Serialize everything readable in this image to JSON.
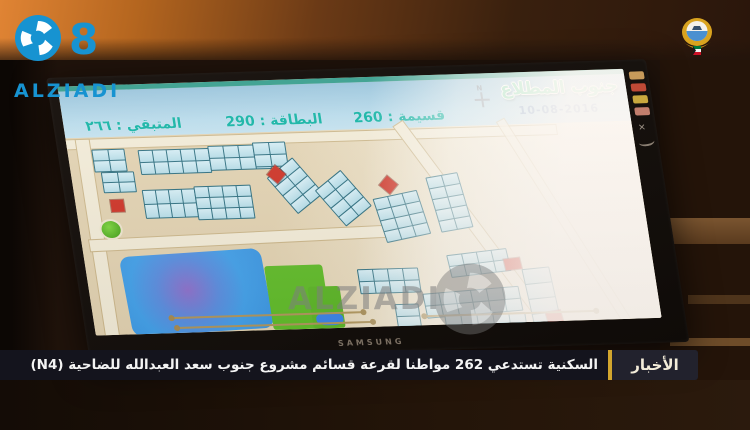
{
  "overlay": {
    "logo": {
      "eight": "8",
      "name": "ALZIADI"
    },
    "watermark": "ALZIADI",
    "ticker": {
      "label": "الأخبار",
      "text": "السكنية تستدعي 262 مواطنا لقرعة قسائم مشروع جنوب سعد العبدالله للضاحية (N4)"
    }
  },
  "monitor": {
    "brand": "SAMSUNG",
    "side_stickers": [
      {
        "color": "#c79a5a"
      },
      {
        "color": "#bf4a36"
      },
      {
        "color": "#c9a83e"
      },
      {
        "color": "#c27e6d"
      }
    ],
    "side_x": "✕",
    "screen": {
      "header": {
        "title": "جنوب المطلاع",
        "date": "10-08-2016",
        "plot": "قسيمة : 260",
        "card": "البطاقة : 290",
        "remaining": "المتبقي : ٢٦٦",
        "badge": "196",
        "compass_label": "N"
      },
      "map": {
        "blocks": [
          {
            "x": 24,
            "y": 12,
            "cols": 2,
            "rows": 2,
            "cw": 15,
            "ch": 10,
            "rot": 0
          },
          {
            "x": 30,
            "y": 35,
            "cols": 2,
            "rows": 2,
            "cw": 15,
            "ch": 9,
            "rot": 0
          },
          {
            "x": 70,
            "y": 14,
            "cols": 5,
            "rows": 2,
            "cw": 13,
            "ch": 11,
            "rot": 0
          },
          {
            "x": 140,
            "y": 12,
            "cols": 4,
            "rows": 2,
            "cw": 14,
            "ch": 11,
            "rot": 0
          },
          {
            "x": 185,
            "y": 10,
            "cols": 2,
            "rows": 2,
            "cw": 15,
            "ch": 11,
            "rot": 0
          },
          {
            "x": 68,
            "y": 54,
            "cols": 4,
            "rows": 2,
            "cw": 12,
            "ch": 13,
            "rot": 0
          },
          {
            "x": 120,
            "y": 52,
            "cols": 4,
            "rows": 3,
            "cw": 13,
            "ch": 10,
            "rot": 0
          },
          {
            "x": 204,
            "y": 32,
            "cols": 2,
            "rows": 4,
            "cw": 16,
            "ch": 10,
            "rot": -35
          },
          {
            "x": 250,
            "y": 46,
            "cols": 2,
            "rows": 4,
            "cw": 16,
            "ch": 10,
            "rot": -35
          },
          {
            "x": 300,
            "y": 66,
            "cols": 3,
            "rows": 4,
            "cw": 14,
            "ch": 10,
            "rot": -10
          },
          {
            "x": 356,
            "y": 48,
            "cols": 2,
            "rows": 5,
            "cw": 15,
            "ch": 10,
            "rot": -8
          },
          {
            "x": 270,
            "y": 140,
            "cols": 4,
            "rows": 2,
            "cw": 14,
            "ch": 11,
            "rot": 0
          },
          {
            "x": 332,
            "y": 164,
            "cols": 6,
            "rows": 2,
            "cw": 15,
            "ch": 11,
            "rot": -3
          },
          {
            "x": 362,
            "y": 126,
            "cols": 4,
            "rows": 2,
            "cw": 14,
            "ch": 10,
            "rot": -5
          },
          {
            "x": 436,
            "y": 144,
            "cols": 1,
            "rows": 4,
            "cw": 26,
            "ch": 14,
            "rot": -4
          },
          {
            "x": 350,
            "y": 188,
            "cols": 5,
            "rows": 1,
            "cw": 15,
            "ch": 11,
            "rot": 0
          },
          {
            "x": 302,
            "y": 176,
            "cols": 1,
            "rows": 3,
            "cw": 22,
            "ch": 11,
            "rot": 0
          }
        ],
        "reds": [
          {
            "x": 35,
            "y": 63,
            "w": 13,
            "h": 12,
            "rot": 0
          },
          {
            "x": 198,
            "y": 36,
            "w": 13,
            "h": 13,
            "rot": 45
          },
          {
            "x": 308,
            "y": 50,
            "w": 13,
            "h": 13,
            "rot": 45
          },
          {
            "x": 418,
            "y": 134,
            "w": 16,
            "h": 11,
            "rot": -5
          },
          {
            "x": 452,
            "y": 188,
            "w": 15,
            "h": 13,
            "rot": -8
          }
        ],
        "dlines": [
          {
            "x": 78,
            "y": 182,
            "w": 192
          },
          {
            "x": 82,
            "y": 192,
            "w": 196
          },
          {
            "x": 330,
            "y": 188,
            "w": 172
          }
        ]
      }
    }
  },
  "colors": {
    "brand_blue": "#1793d1",
    "ticker_gold": "#d2a62e",
    "header_teal_text": "#0fb3a4",
    "title_green": "#7fd9ad",
    "map_red": "#cf3326",
    "lake_blue": "#459fe8",
    "park_green": "#63bd2c",
    "badge_blue": "#1356c4"
  }
}
